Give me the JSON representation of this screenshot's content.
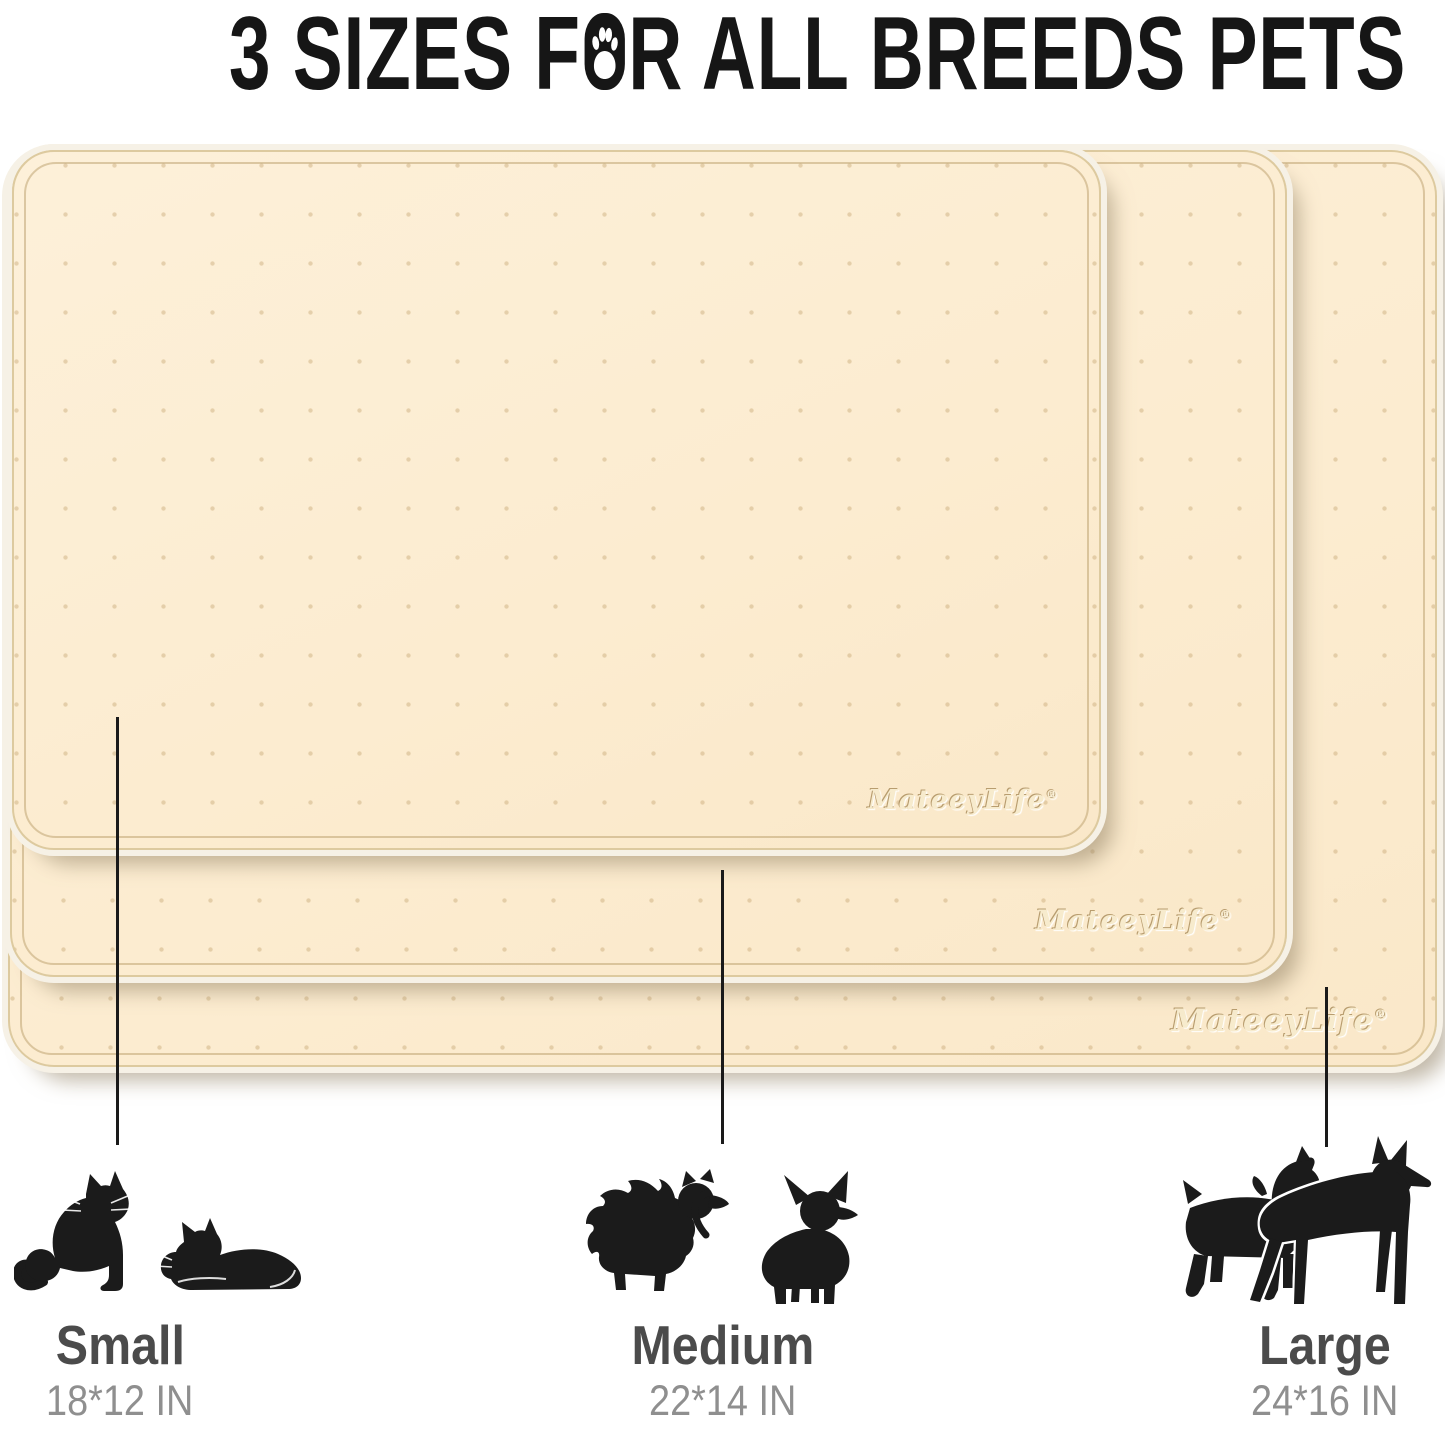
{
  "title": {
    "text_before_paw": "3 SIZES F",
    "text_after_paw": "R ALL BREEDS PETS"
  },
  "brand": {
    "name": "MateeyLife",
    "registered": "®"
  },
  "mats": {
    "layers": [
      {
        "id": "large",
        "stack_position": "back"
      },
      {
        "id": "medium",
        "stack_position": "middle"
      },
      {
        "id": "small",
        "stack_position": "front"
      }
    ],
    "texture": "embossed dot grid"
  },
  "sizes": [
    {
      "name": "Small",
      "dimensions": "18*12 IN",
      "pets": [
        "sitting-cat",
        "lying-cat"
      ]
    },
    {
      "name": "Medium",
      "dimensions": "22*14 IN",
      "pets": [
        "pomeranian",
        "chihuahua"
      ]
    },
    {
      "name": "Large",
      "dimensions": "24*16 IN",
      "pets": [
        "schnauzer",
        "doberman"
      ]
    }
  ],
  "colors": {
    "mat_surface": "#fdecd2",
    "mat_groove": "#baa06a",
    "mat_rim": "#f6f1e6",
    "title_text": "#161616",
    "label_name": "#4b4b4b",
    "label_dims": "#8f8f8f",
    "leader_line": "#1a1a1a",
    "silhouette": "#1b1b1b"
  }
}
